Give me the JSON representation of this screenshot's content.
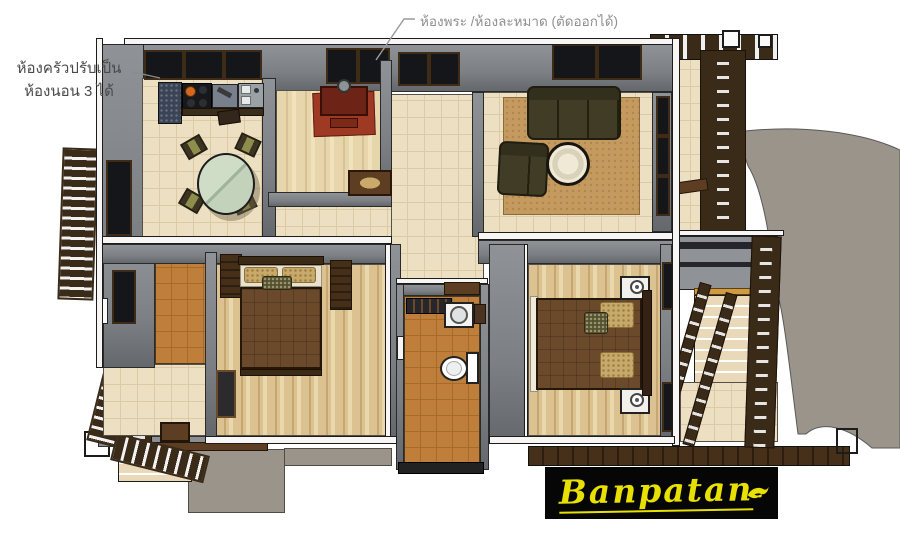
{
  "annotations": {
    "prayer_note": "ห้องพระ /ห้องละหมาด (ตัดออกได้)",
    "kitchen_note_line1": "ห้องครัวปรับเป็น",
    "kitchen_note_line2": "ห้องนอน 3 ได้"
  },
  "logo": {
    "text": "Banpatan",
    "swirl_icon": "bird-swirl-icon"
  },
  "scene": {
    "type": "house-floor-plan-3d-top-view",
    "rooms": [
      "kitchen-dining",
      "prayer-room",
      "entry-hall",
      "living-room",
      "bedroom-left",
      "utility-room",
      "bathroom",
      "master-bedroom",
      "porch",
      "balcony",
      "stair-landing"
    ],
    "furniture": [
      "stove",
      "kitchen-sink",
      "granite-counter",
      "dining-table",
      "dining-chairs",
      "altar-table",
      "prayer-rug",
      "sofa",
      "armchair",
      "coffee-table",
      "area-rug",
      "bed",
      "wardrobe",
      "nightstands",
      "toilet",
      "bathroom-sink",
      "shower-mat"
    ],
    "exterior": [
      "driveway",
      "concrete-path",
      "wood-stairs",
      "pergola",
      "trellis",
      "deck",
      "railings"
    ]
  },
  "palette": {
    "bg": "#ffffff",
    "concrete": "#9a948b",
    "wall_gray": "#7c7f84",
    "wall_gray_light": "#8f9296",
    "wall_cap": "#f7f6f4",
    "outline": "#1c1c1c",
    "floor_cream": "#ecdfc2",
    "floor_grid": "#dccaa6",
    "wood_floor": "#dcc291",
    "wood_streak": "#c6a771",
    "prayer_wood": "#e7d5ac",
    "tile_orange": "#bf7f3a",
    "tile_grid": "#a36c2c",
    "rug_tan": "#c49a5e",
    "rug_red": "#9e3a23",
    "altar_red": "#6d2416",
    "sofa_olive": "#413c26",
    "chair_olive": "#8d8e4e",
    "glass_green": "#c3d3bb",
    "counter_steel": "#9aa2a6",
    "stove_black": "#17181c",
    "burner_orange": "#d2691e",
    "granite_blue": "#3b4356",
    "bed_blanket": "#6b4a2c",
    "pillow_tan": "#c9a968",
    "pillow_dark": "#55512f",
    "headboard": "#3a2a16",
    "wood_dark": "#3a2a18",
    "wood_mid": "#5d3e22",
    "step_cream": "#ead9b8",
    "deck_brown": "#46301a",
    "logo_bg": "#060606",
    "logo_yellow": "#e8e000",
    "note_gray": "#8f8f8f",
    "note_dark": "#4a4a4a"
  }
}
